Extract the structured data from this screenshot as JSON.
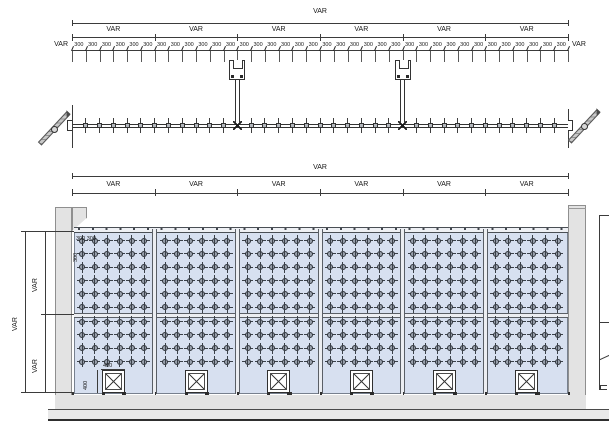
{
  "plan": {
    "overall_label": "VAR",
    "bay_labels": [
      "VAR",
      "VAR",
      "VAR",
      "VAR",
      "VAR",
      "VAR"
    ],
    "unit_label": "300",
    "unit_count": 36,
    "left_end_label": "VAR",
    "right_end_label": "VAR",
    "bays": 6,
    "support_brackets": 2
  },
  "elevation": {
    "overall_label": "VAR",
    "bay_labels": [
      "VAR",
      "VAR",
      "VAR",
      "VAR",
      "VAR",
      "VAR"
    ],
    "vertical_overall_label": "VAR",
    "vertical_upper_label": "VAR",
    "vertical_lower_label": "VAR",
    "spacing_h_label": "300 300",
    "spacing_v_label": "300",
    "door_width_label": "400",
    "door_height_label": "400",
    "bays": 6,
    "spider_cols_per_bay": 6,
    "spider_rows_upper": 6,
    "spider_rows_lower": 4,
    "door_count": 6
  },
  "colors": {
    "glass_fill": "#d7e0f0",
    "wall_fill": "#e3e3e3",
    "line_dark": "#3b3b3b",
    "fitting_gray": "#99a1ad"
  }
}
